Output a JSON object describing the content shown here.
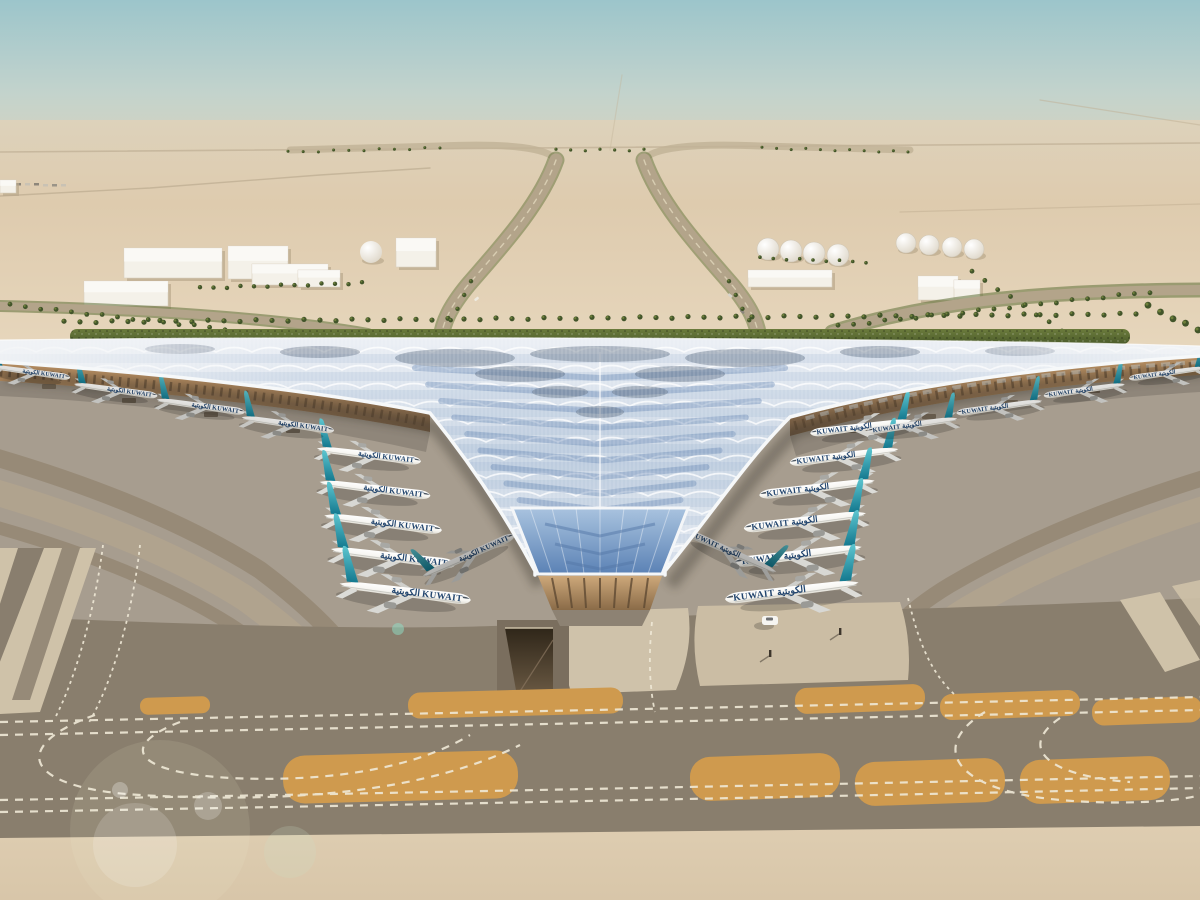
{
  "image": {
    "kind": "aerial-architectural-rendering",
    "description": "Aerial rendering of a desert airport: a trefoil terminal with a rippling silver-blue glazed roof, rows of teal-tailed KUWAIT jets docked on both piers, palm-lined approach roads and white support buildings behind, broad taxiways with white dashed markings and ochre painted pads in the foreground."
  },
  "airline": {
    "title": "KUWAIT",
    "title_arabic": "الكويتية"
  },
  "scene_counts": {
    "aircraft_visible": 21,
    "left_pier_gates": 5,
    "right_pier_gates": 6,
    "fuel_tanks": 8
  },
  "palette": {
    "sky_top": "#9cc5cb",
    "sky_mid": "#c3d3cc",
    "haze": "#ddd2bb",
    "desert": "#decbae",
    "desert_far": "#e7d7bd",
    "road_tan": "#b5a68b",
    "building_white": "#f4f1e9",
    "palm_green": "#42552a",
    "hedge_green": "#5b6b33",
    "roof_light": "#eef1f6",
    "roof_base": "#c7d4e3",
    "roof_blue": "#8da9ca",
    "roof_deep": "#6f8fb8",
    "roof_dark": "#5a6a7e",
    "fascia": "#f6f8f9",
    "facade_light": "#bc9264",
    "facade_dark": "#6e5740",
    "apron": "#a79d8f",
    "arc_light": "#b9a88e",
    "arc_dark": "#8b7b64",
    "taxiway": "#897e6d",
    "pad_light": "#cfc2a9",
    "trench": "#5c4c3b",
    "orange": "#cf9a4e",
    "marking": "#f0e9d7",
    "sand": "#d8c6a9",
    "tail_teal": "#14798f",
    "tail_light": "#5ec6d0",
    "fuselage_white": "#f7f6f2",
    "title_navy": "#22456e",
    "shadow": "#3a342c"
  },
  "aircraft_placements": [
    {
      "x": 368,
      "y": 455,
      "s": 0.92,
      "r": 7,
      "flip": false,
      "dim": 1
    },
    {
      "x": 374,
      "y": 489,
      "s": 0.98,
      "r": 7,
      "flip": false,
      "dim": 1
    },
    {
      "x": 382,
      "y": 523,
      "s": 1.04,
      "r": 7,
      "flip": false,
      "dim": 1
    },
    {
      "x": 392,
      "y": 557,
      "s": 1.1,
      "r": 7,
      "flip": false,
      "dim": 1
    },
    {
      "x": 404,
      "y": 592,
      "s": 1.16,
      "r": 7,
      "flip": false,
      "dim": 1
    },
    {
      "x": 30,
      "y": 372,
      "s": 0.7,
      "r": 8,
      "flip": false,
      "dim": 0.9
    },
    {
      "x": 115,
      "y": 390,
      "s": 0.74,
      "r": 8,
      "flip": false,
      "dim": 0.9
    },
    {
      "x": 200,
      "y": 406,
      "s": 0.78,
      "r": 8,
      "flip": false,
      "dim": 0.9
    },
    {
      "x": 287,
      "y": 424,
      "s": 0.82,
      "r": 8,
      "flip": false,
      "dim": 0.9
    },
    {
      "x": 468,
      "y": 556,
      "s": 0.88,
      "r": -24,
      "flip": false,
      "dim": 0.72
    },
    {
      "x": 862,
      "y": 427,
      "s": 0.9,
      "r": -7,
      "flip": true,
      "dim": 1
    },
    {
      "x": 845,
      "y": 456,
      "s": 0.96,
      "r": -7,
      "flip": true,
      "dim": 1
    },
    {
      "x": 818,
      "y": 488,
      "s": 1.02,
      "r": -7,
      "flip": true,
      "dim": 1
    },
    {
      "x": 806,
      "y": 521,
      "s": 1.08,
      "r": -7,
      "flip": true,
      "dim": 1
    },
    {
      "x": 799,
      "y": 555,
      "s": 1.13,
      "r": -7,
      "flip": true,
      "dim": 1
    },
    {
      "x": 793,
      "y": 591,
      "s": 1.18,
      "r": -7,
      "flip": true,
      "dim": 1
    },
    {
      "x": 1168,
      "y": 373,
      "s": 0.68,
      "r": -8,
      "flip": true,
      "dim": 0.9
    },
    {
      "x": 1085,
      "y": 390,
      "s": 0.72,
      "r": -8,
      "flip": true,
      "dim": 0.9
    },
    {
      "x": 1000,
      "y": 407,
      "s": 0.76,
      "r": -8,
      "flip": true,
      "dim": 0.9
    },
    {
      "x": 913,
      "y": 425,
      "s": 0.8,
      "r": -8,
      "flip": true,
      "dim": 0.9
    },
    {
      "x": 731,
      "y": 552,
      "s": 0.88,
      "r": 24,
      "flip": true,
      "dim": 0.72
    }
  ],
  "palm_rows": [
    {
      "x1": 64,
      "y1": 322,
      "x2": 1136,
      "y2": 314,
      "n": 68,
      "r": 2.6
    },
    {
      "x1": 200,
      "y1": 288,
      "x2": 362,
      "y2": 283,
      "n": 13,
      "r": 2.2
    },
    {
      "x1": 972,
      "y1": 272,
      "x2": 1062,
      "y2": 331,
      "n": 8,
      "r": 2.4
    },
    {
      "x1": 838,
      "y1": 326,
      "x2": 1150,
      "y2": 292,
      "n": 21,
      "r": 2.4
    },
    {
      "x1": 10,
      "y1": 305,
      "x2": 225,
      "y2": 329,
      "n": 15,
      "r": 2.4
    },
    {
      "x1": 471,
      "y1": 282,
      "x2": 444,
      "y2": 334,
      "n": 5,
      "r": 2.2
    },
    {
      "x1": 729,
      "y1": 282,
      "x2": 756,
      "y2": 334,
      "n": 5,
      "r": 2.2
    },
    {
      "x1": 760,
      "y1": 258,
      "x2": 866,
      "y2": 262,
      "n": 9,
      "r": 1.8
    },
    {
      "x1": 1148,
      "y1": 306,
      "x2": 1198,
      "y2": 330,
      "n": 5,
      "r": 3.4
    },
    {
      "x1": 556,
      "y1": 150,
      "x2": 644,
      "y2": 150,
      "n": 7,
      "r": 1.6
    },
    {
      "x1": 288,
      "y1": 152,
      "x2": 440,
      "y2": 148,
      "n": 11,
      "r": 1.5
    },
    {
      "x1": 762,
      "y1": 148,
      "x2": 908,
      "y2": 152,
      "n": 11,
      "r": 1.5
    }
  ],
  "buildings": {
    "boxes": [
      [
        84,
        281,
        84,
        25
      ],
      [
        124,
        248,
        98,
        30
      ],
      [
        228,
        246,
        60,
        33
      ],
      [
        252,
        264,
        76,
        21
      ],
      [
        298,
        270,
        42,
        17
      ],
      [
        396,
        238,
        40,
        29
      ],
      [
        748,
        270,
        84,
        17
      ],
      [
        918,
        276,
        40,
        24
      ],
      [
        954,
        280,
        26,
        19
      ],
      [
        0,
        180,
        16,
        13
      ]
    ],
    "tanks": [
      [
        768,
        249,
        11
      ],
      [
        791,
        251,
        11
      ],
      [
        814,
        253,
        11
      ],
      [
        838,
        255,
        11
      ],
      [
        906,
        243,
        10
      ],
      [
        929,
        245,
        10
      ],
      [
        952,
        247,
        10
      ],
      [
        974,
        249,
        10
      ]
    ],
    "domes": [
      [
        371,
        252,
        11
      ]
    ]
  }
}
